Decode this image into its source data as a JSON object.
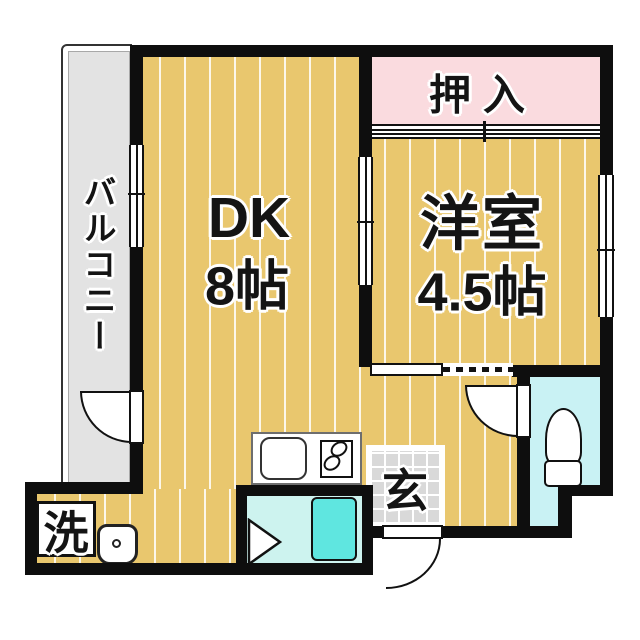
{
  "labels": {
    "balcony": "バルコニー",
    "dk": "DK",
    "dk_size": "8帖",
    "western_room": "洋室",
    "western_room_size": "4.5帖",
    "closet": "押入",
    "entrance": "玄",
    "laundry": "洗"
  },
  "colors": {
    "floor_orange": "#e9c76e",
    "closet_pink": "#fadbdf",
    "wet_area_cyan": "#c9f2f4",
    "bathtub_cyan": "#5fe6e0",
    "balcony_gray": "#e3e3e3",
    "entrance_tile_gray": "#d9d9d9",
    "wall_black": "#0e0e0e"
  },
  "fixtures": {
    "kitchen_sink": "sink",
    "gas_stove": "two-burner stove",
    "bathtub": "bathtub",
    "toilet": "toilet",
    "washing_machine": "washing machine place"
  }
}
